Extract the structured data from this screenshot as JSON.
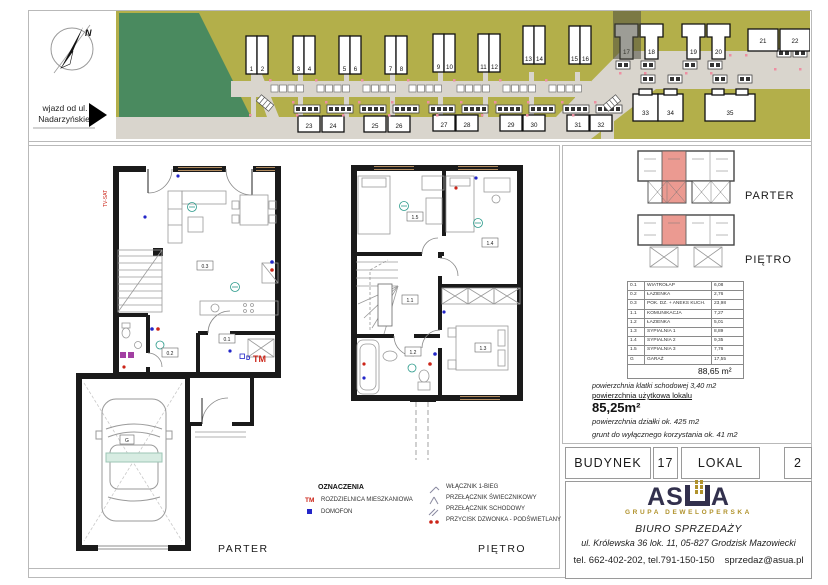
{
  "site_plan": {
    "north_label": "N",
    "entrance_label_line1": "wjazd od ul.",
    "entrance_label_line2": "Nadarzyńskiej",
    "building_labels": [
      "1",
      "2",
      "3",
      "4",
      "5",
      "6",
      "7",
      "8",
      "9",
      "10",
      "11",
      "12",
      "13",
      "14",
      "15",
      "16",
      "17",
      "18",
      "19",
      "20",
      "21",
      "22",
      "23",
      "24",
      "25",
      "26",
      "27",
      "28",
      "29",
      "30",
      "31",
      "32",
      "33",
      "34",
      "35"
    ],
    "highlighted_building": "17"
  },
  "floor_plans": {
    "parter": {
      "label": "PARTER",
      "room_labels": {
        "r03": "0.3",
        "r02": "0.2",
        "r01": "0.1",
        "g": "G"
      },
      "tm": "TM",
      "d": "D",
      "tv": "TV-SAT"
    },
    "pietro": {
      "label": "PIĘTRO",
      "room_labels": {
        "r11": "1.1",
        "r12": "1.2",
        "r13": "1.3",
        "r14": "1.4",
        "r15": "1.5"
      }
    }
  },
  "unit_locator": {
    "parter_label": "PARTER",
    "pietro_label": "PIĘTRO"
  },
  "area_table": {
    "rows": [
      {
        "id": "0.1",
        "name": "WIATROŁAP",
        "area": "6,08"
      },
      {
        "id": "0.2",
        "name": "ŁAZIENKA",
        "area": "2,76"
      },
      {
        "id": "0.3",
        "name": "POK. DZ. + ANEKS KUCH.",
        "area": "23,98"
      },
      {
        "id": "1.1",
        "name": "KOMUNIKACJA",
        "area": "7,27"
      },
      {
        "id": "1.2",
        "name": "ŁAZIENKA",
        "area": "5,01"
      },
      {
        "id": "1.3",
        "name": "SYPIALNIA 1",
        "area": "8,89"
      },
      {
        "id": "1.4",
        "name": "SYPIALNIA 2",
        "area": "9,35"
      },
      {
        "id": "1.5",
        "name": "SYPIALNIA 3",
        "area": "7,76"
      },
      {
        "id": "G",
        "name": "GARAŻ",
        "area": "17,55"
      }
    ],
    "total": "88,65 m²"
  },
  "area_notes": {
    "stairwell": "powierzchnia klatki schodowej 3,40 m2",
    "usable_label": "powierzchnia użytkowa lokalu",
    "usable_value": "85,25m²",
    "plot": "powierzchnia działki ok. 425 m2",
    "exclusive_ground": "grunt do wyłącznego korzystania ok. 41 m2"
  },
  "unit_info": {
    "building_label": "BUDYNEK",
    "building_number": "17",
    "unit_label": "LOKAL",
    "unit_number": "2"
  },
  "legend": {
    "title": "OZNACZENIA",
    "left_items": [
      {
        "symbol": "TM",
        "label": "ROZDZIELNICA MIESZKANIOWA"
      },
      {
        "symbol": "D",
        "label": "DOMOFON"
      }
    ],
    "right_items": [
      "WŁĄCZNIK 1-BIEG",
      "PRZEŁĄCZNIK ŚWIECZNIKOWY",
      "PRZEŁĄCZNIK SCHODOWY",
      "PRZYCISK DZWONKA - PODŚWIETLANY"
    ]
  },
  "developer": {
    "name_part1": "AS",
    "name_part2": "A",
    "tagline": "GRUPA DEWELOPERSKA",
    "office": "BIURO SPRZEDAŻY",
    "address": "ul. Królewska 36 lok. 11, 05-827  Grodzisk Mazowiecki",
    "phones": "tel. 662-402-202, tel.791-150-150",
    "email": "sprzedaz@asua.pl"
  },
  "colors": {
    "accent_red": "#cc2418",
    "accent_blue": "#2326c8",
    "site_green": "#4a8a5f",
    "site_olive": "#b3af4a",
    "road": "#d9d5cd",
    "highlight_unit": "#eb9a91",
    "logo_navy": "#32304d",
    "logo_gold": "#b0922c"
  }
}
